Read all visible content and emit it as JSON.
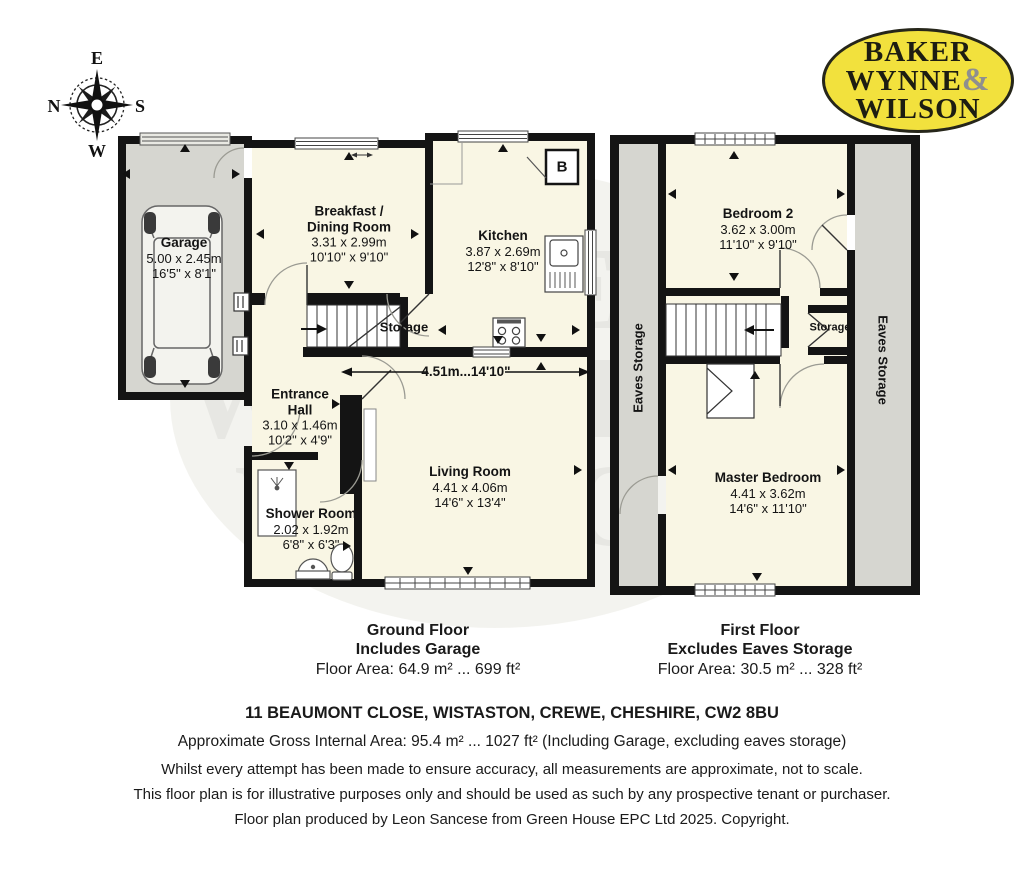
{
  "compass": {
    "top": "E",
    "left": "N",
    "right": "S",
    "bottom": "W"
  },
  "logo": {
    "line1": "BAKER",
    "line2": "WYNNE",
    "ampersand": "&",
    "line3": "WILSON"
  },
  "watermark": {
    "line1": "BAKER",
    "line2": "WYNNE &",
    "line3": "WILSON"
  },
  "ground_floor": {
    "garage": {
      "name": "Garage",
      "metric": "5.00 x 2.45m",
      "imperial": "16'5\" x 8'1\""
    },
    "breakfast_dining": {
      "name": "Breakfast / Dining Room",
      "metric": "3.31 x 2.99m",
      "imperial": "10'10\" x 9'10\""
    },
    "kitchen": {
      "name": "Kitchen",
      "metric": "3.87 x 2.69m",
      "imperial": "12'8\" x 8'10\""
    },
    "storage": {
      "name": "Storage"
    },
    "entrance_hall": {
      "name": "Entrance Hall",
      "metric": "3.10 x 1.46m",
      "imperial": "10'2\" x 4'9\""
    },
    "shower_room": {
      "name": "Shower Room",
      "metric": "2.02 x 1.92m",
      "imperial": "6'8\" x 6'3\""
    },
    "living_room": {
      "name": "Living Room",
      "metric": "4.41 x 4.06m",
      "imperial": "14'6\" x 13'4\""
    },
    "hall_dimension": "4.51m...14'10\"",
    "boiler": "B"
  },
  "first_floor": {
    "bedroom2": {
      "name": "Bedroom 2",
      "metric": "3.62 x 3.00m",
      "imperial": "11'10\" x 9'10\""
    },
    "master_bedroom": {
      "name": "Master Bedroom",
      "metric": "4.41 x 3.62m",
      "imperial": "14'6\" x 11'10\""
    },
    "storage": {
      "name": "Storage"
    },
    "eaves_left": "Eaves Storage",
    "eaves_right": "Eaves Storage"
  },
  "captions": {
    "ground": {
      "title": "Ground Floor",
      "subtitle": "Includes Garage",
      "area": "Floor Area: 64.9 m² ... 699 ft²"
    },
    "first": {
      "title": "First Floor",
      "subtitle": "Excludes Eaves Storage",
      "area": "Floor Area: 30.5 m² ... 328 ft²"
    }
  },
  "footer": {
    "address": "11 BEAUMONT CLOSE, WISTASTON, CREWE, CHESHIRE, CW2 8BU",
    "gross_area": "Approximate Gross Internal Area: 95.4 m² ... 1027 ft² (Including Garage, excluding eaves storage)",
    "disclaimer1": "Whilst every attempt has been made to ensure accuracy, all measurements are approximate, not to scale.",
    "disclaimer2": "This floor plan is for illustrative purposes only and should be used as such by any prospective tenant or purchaser.",
    "disclaimer3": "Floor plan produced by Leon Sancese from Green House EPC Ltd 2025. Copyright."
  },
  "colors": {
    "wall": "#141414",
    "room_fill": "#f9f6e4",
    "grey_fill": "#d6d6d0",
    "logo_yellow": "#f2e13d"
  }
}
